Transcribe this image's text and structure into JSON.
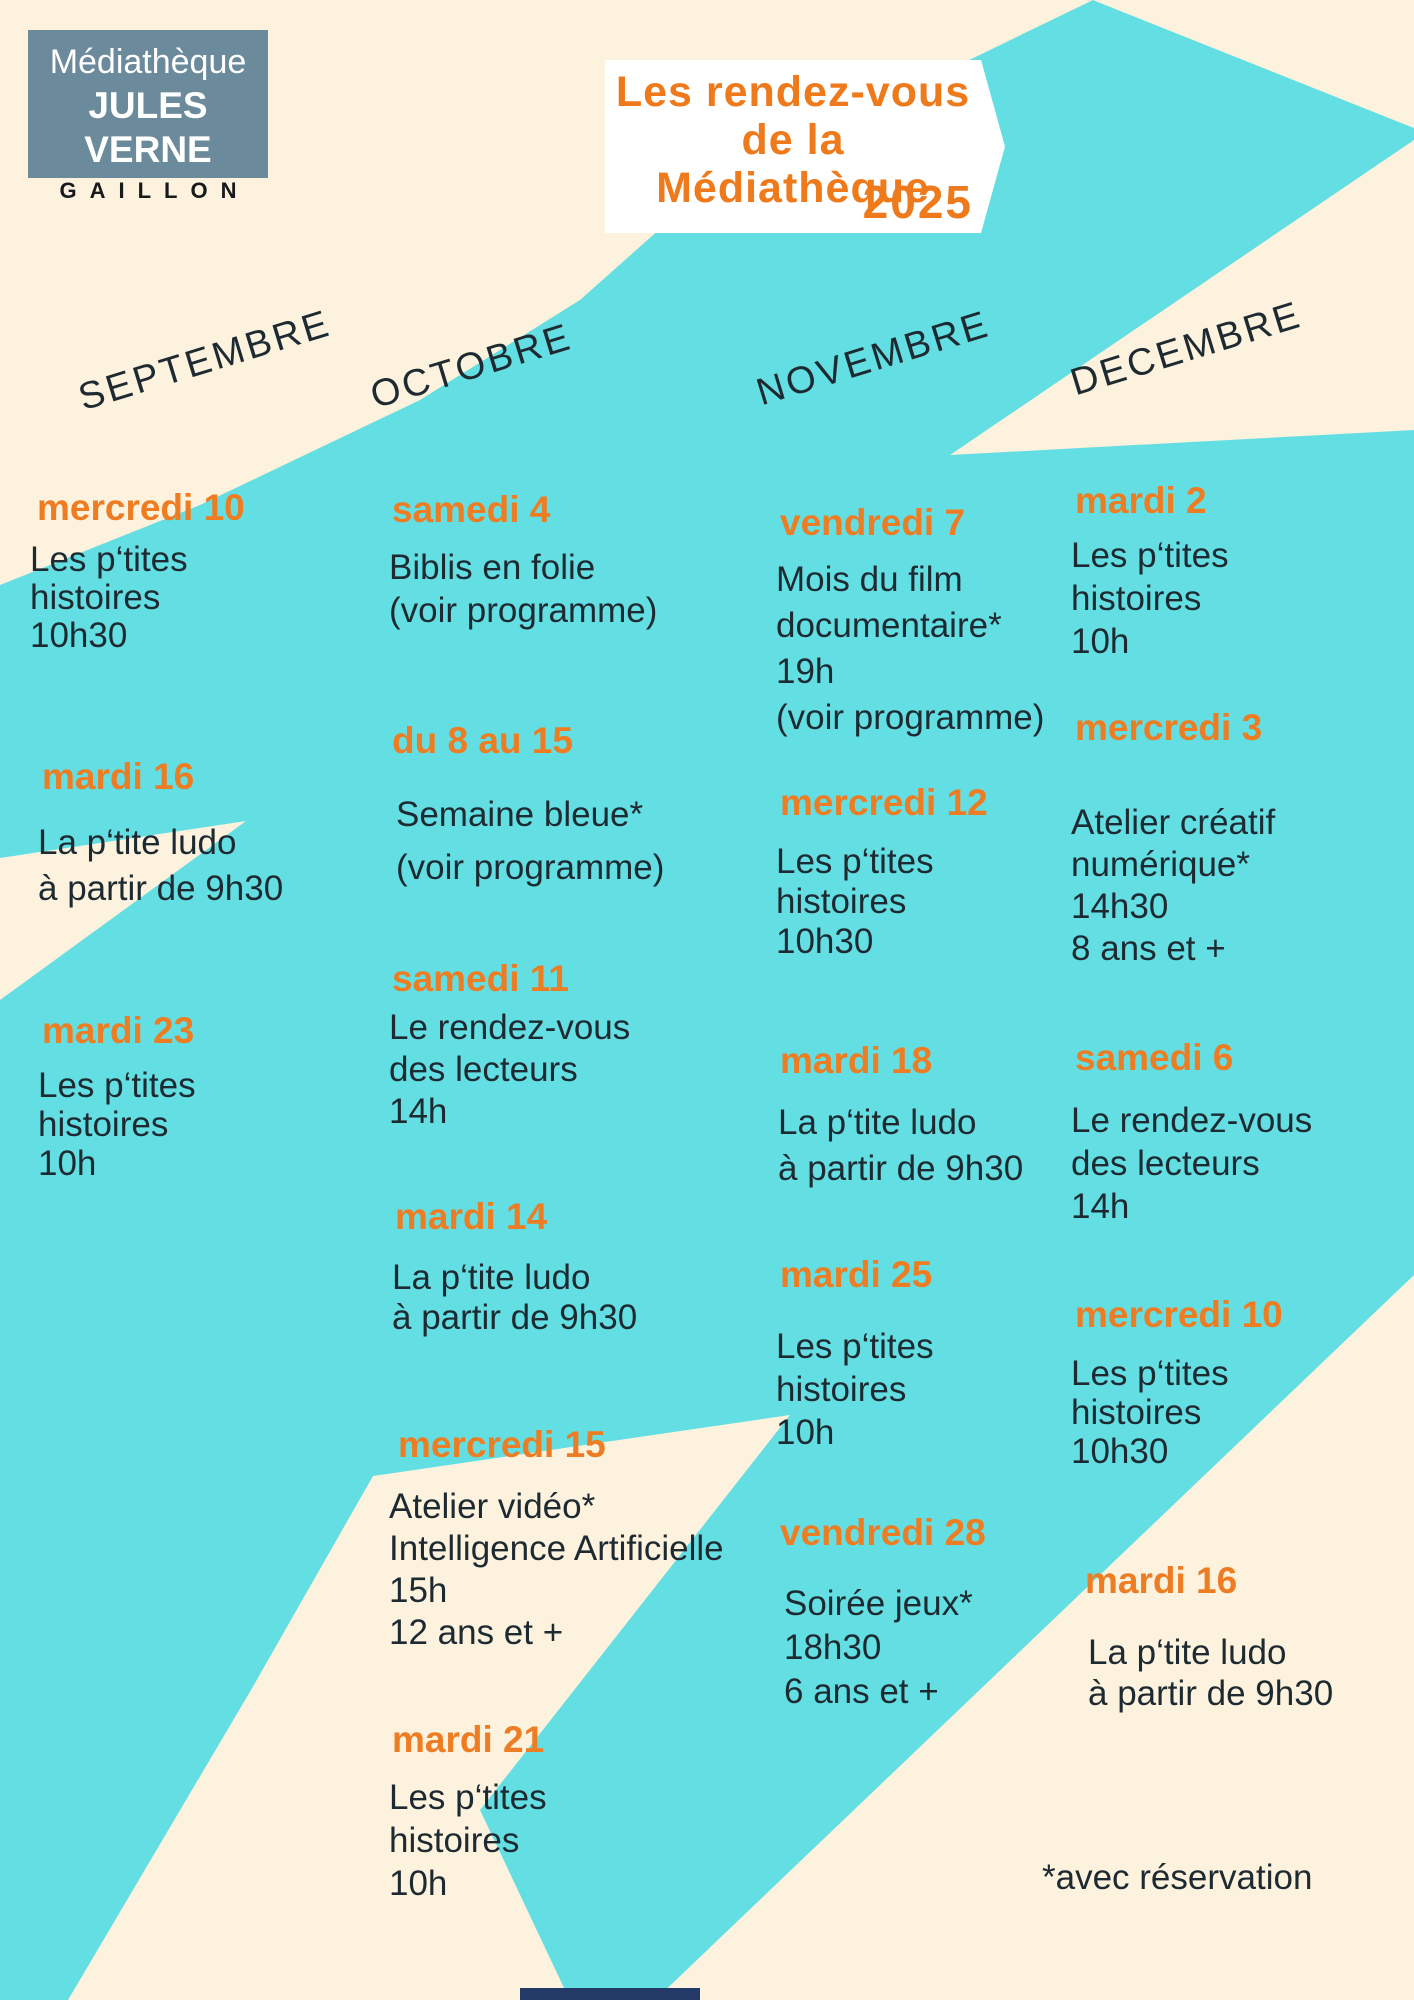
{
  "colors": {
    "cream": "#fcf2dd",
    "turquoise": "#63dee2",
    "orange": "#ee7c22",
    "ink": "#1e2a32",
    "logo_bg": "#6b8a9b",
    "navy": "#233a66",
    "white": "#ffffff"
  },
  "logo": {
    "line1": "Médiathèque",
    "line2": "JULES VERNE",
    "line3": "GAILLON"
  },
  "title": {
    "line1": "Les rendez-vous",
    "line2": "de la Médiathèque",
    "year": "2025"
  },
  "months": [
    {
      "name": "SEPTEMBRE",
      "events": [
        {
          "date": "mercredi 10",
          "lines": [
            "Les p‘tites",
            "histoires",
            "10h30"
          ]
        },
        {
          "date": "mardi 16",
          "lines": [
            "La p‘tite ludo",
            "à partir de 9h30"
          ]
        },
        {
          "date": "mardi 23",
          "lines": [
            "Les p‘tites",
            "histoires",
            "10h"
          ]
        }
      ]
    },
    {
      "name": "OCTOBRE",
      "events": [
        {
          "date": "samedi 4",
          "lines": [
            "Biblis en folie",
            "(voir programme)"
          ]
        },
        {
          "date": "du 8 au 15",
          "lines": [
            "Semaine bleue*",
            "(voir programme)"
          ]
        },
        {
          "date": "samedi 11",
          "lines": [
            "Le rendez-vous",
            "des lecteurs",
            "14h"
          ]
        },
        {
          "date": "mardi 14",
          "lines": [
            "La p‘tite ludo",
            "à partir de 9h30"
          ]
        },
        {
          "date": "mercredi 15",
          "lines": [
            "Atelier vidéo*",
            "Intelligence Artificielle",
            "15h",
            "12 ans et +"
          ]
        },
        {
          "date": "mardi 21",
          "lines": [
            "Les p‘tites",
            "histoires",
            "10h"
          ]
        }
      ]
    },
    {
      "name": "NOVEMBRE",
      "events": [
        {
          "date": "vendredi 7",
          "lines": [
            "Mois du film",
            "documentaire*",
            "19h",
            "(voir programme)"
          ]
        },
        {
          "date": "mercredi 12",
          "lines": [
            "Les p‘tites",
            "histoires",
            "10h30"
          ]
        },
        {
          "date": "mardi 18",
          "lines": [
            "La p‘tite ludo",
            "à partir de 9h30"
          ]
        },
        {
          "date": "mardi 25",
          "lines": [
            "Les p‘tites",
            "histoires",
            "10h"
          ]
        },
        {
          "date": "vendredi 28",
          "lines": [
            "Soirée jeux*",
            "18h30",
            "6 ans et +"
          ]
        }
      ]
    },
    {
      "name": "DECEMBRE",
      "events": [
        {
          "date": "mardi 2",
          "lines": [
            "Les p‘tites",
            "histoires",
            "10h"
          ]
        },
        {
          "date": "mercredi 3",
          "lines": [
            "Atelier créatif",
            "numérique*",
            "14h30",
            "8 ans et +"
          ]
        },
        {
          "date": "samedi 6",
          "lines": [
            "Le rendez-vous",
            "des lecteurs",
            "14h"
          ]
        },
        {
          "date": "mercredi 10",
          "lines": [
            "Les p‘tites",
            "histoires",
            "10h30"
          ]
        },
        {
          "date": "mardi 16",
          "lines": [
            "La p‘tite ludo",
            "à partir de 9h30"
          ]
        }
      ]
    }
  ],
  "footnote": "*avec réservation"
}
